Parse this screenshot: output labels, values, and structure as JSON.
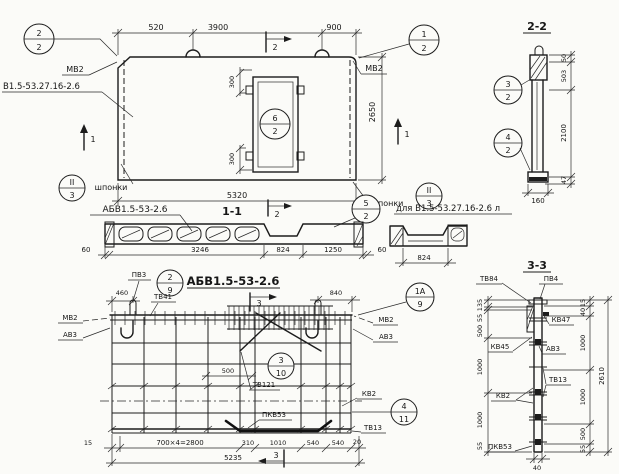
{
  "plan": {
    "dim_520": "520",
    "dim_3900": "3900",
    "dim_900": "900",
    "dim_2650": "2650",
    "dim_5320": "5320",
    "dim_300_top": "300",
    "dim_300_bottom": "300",
    "cut2_top": "2",
    "cut2_bottom": "2",
    "cut1_left": "1",
    "cut1_right": "1",
    "callout_left_top": "2",
    "callout_left_bottom": "2",
    "callout_right_top": "1",
    "callout_right_bottom": "2",
    "callout_opening_top": "6",
    "callout_opening_bottom": "2",
    "keys_left_callout_top": "II",
    "keys_left_callout_bottom": "3",
    "keys_right_callout_top": "II",
    "keys_right_callout_bottom": "3",
    "label_mv2_left": "МВ2",
    "label_mv2_right": "МВ2",
    "label_product": "В1.5-53.27.16-2.6",
    "label_keys_left": "шпонки",
    "label_keys_right": "шпонки"
  },
  "section22": {
    "title": "2-2",
    "dim_50": "50",
    "dim_503": "503",
    "dim_2100": "2100",
    "dim_47": "47",
    "dim_160": "160",
    "callout_32_top": "3",
    "callout_32_bottom": "2",
    "callout_42_top": "4",
    "callout_42_bottom": "2"
  },
  "section11": {
    "title": "1-1",
    "label": "АБВ1.5-53-2.6",
    "label_variant": "для В1.5-53.27.16-2.6 л",
    "cut2": "2",
    "callout_52_top": "5",
    "callout_52_bottom": "2",
    "dim_60_left": "60",
    "dim_3246": "3246",
    "dim_824": "824",
    "dim_1250": "1250",
    "dim_60_right": "60",
    "dim_824_variant": "824"
  },
  "elevation": {
    "title": "АБВ1.5-53-2.6",
    "label_pv3": "ПВ3",
    "label_tv41": "ТВ41",
    "label_mv2_left": "МВ2",
    "label_av3_left": "АВ3",
    "label_mv2_right": "МВ2",
    "label_av3_right": "АВ3",
    "label_tv121": "ТВ121",
    "label_kv2": "КВ2",
    "label_tv13": "ТВ13",
    "label_pkv53": "ПКВ53",
    "callout_29_top": "2",
    "callout_29_bottom": "9",
    "callout_1a9_top": "1А",
    "callout_1a9_bottom": "9",
    "callout_310_top": "3",
    "callout_310_bottom": "10",
    "callout_411_top": "4",
    "callout_411_bottom": "11",
    "cut3_top": "3",
    "cut3_bottom": "3",
    "dim_460": "460",
    "dim_840": "840",
    "dim_500": "500",
    "dim_15": "15",
    "dim_700x4": "700×4=2800",
    "dim_310": "310",
    "dim_1010": "1010",
    "dim_540_a": "540",
    "dim_540_b": "540",
    "dim_20": "20",
    "dim_5235": "5235"
  },
  "section33": {
    "title": "3-3",
    "label_tv84": "ТВ84",
    "label_pv4": "ПВ4",
    "label_kv47": "КВ47",
    "label_kv45": "КВ45",
    "label_av3": "АВ3",
    "label_kv2": "КВ2",
    "label_tv13": "ТВ13",
    "label_pkv53": "ПКВ53",
    "dim_40": "40",
    "dim_2610": "2610",
    "left_dims": [
      "135",
      "55",
      "500",
      "1000",
      "1000",
      "55"
    ],
    "right_dims": [
      "15",
      "40",
      "1000",
      "1000",
      "500",
      "55"
    ]
  }
}
